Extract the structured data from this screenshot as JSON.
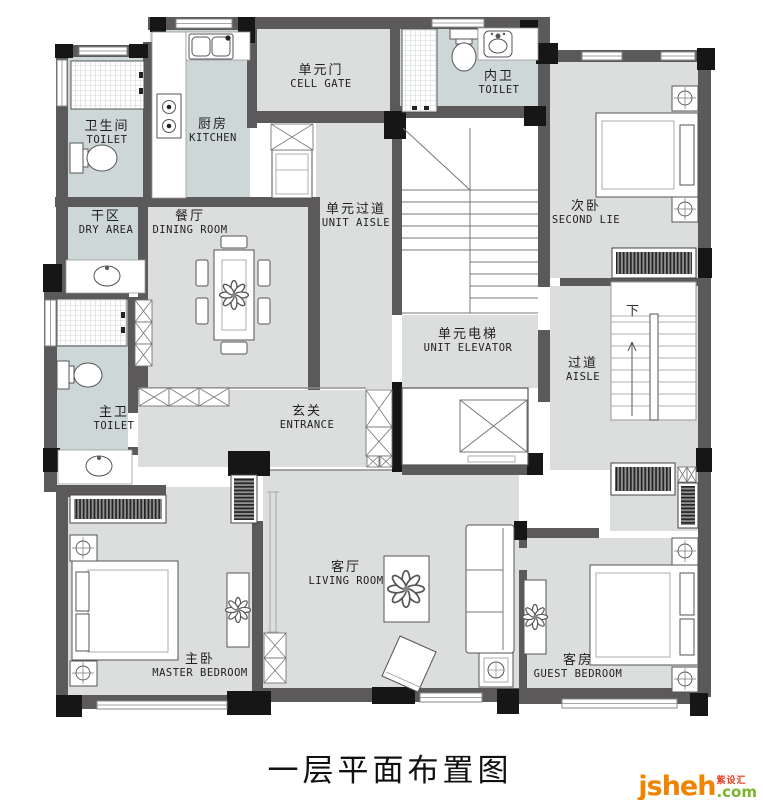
{
  "title": "一层平面布置图",
  "stairs": {
    "down": "下"
  },
  "rooms": {
    "toilet1": {
      "zh": "卫生间",
      "en": "TOILET"
    },
    "kitchen": {
      "zh": "厨房",
      "en": "KITCHEN"
    },
    "dry_area": {
      "zh": "干区",
      "en": "DRY AREA"
    },
    "dining": {
      "zh": "餐厅",
      "en": "DINING ROOM"
    },
    "cell_gate": {
      "zh": "单元门",
      "en": "CELL GATE"
    },
    "inner_toilet": {
      "zh": "内卫",
      "en": "TOILET"
    },
    "unit_aisle": {
      "zh": "单元过道",
      "en": "UNIT AISLE"
    },
    "second_bedroom": {
      "zh": "次卧",
      "en": "SECOND LIE"
    },
    "unit_elevator": {
      "zh": "单元电梯",
      "en": "UNIT ELEVATOR"
    },
    "aisle": {
      "zh": "过道",
      "en": "AISLE"
    },
    "master_toilet": {
      "zh": "主卫",
      "en": "TOILET"
    },
    "entrance": {
      "zh": "玄关",
      "en": "ENTRANCE"
    },
    "master_bedroom": {
      "zh": "主卧",
      "en": "MASTER BEDROOM"
    },
    "living_room": {
      "zh": "客厅",
      "en": "LIVING ROOM"
    },
    "guest_bedroom": {
      "zh": "客房",
      "en": "GUEST BEDROOM"
    }
  },
  "watermark": {
    "name": "jsheh",
    "tld": ".com",
    "badge": "紫设汇"
  },
  "colors": {
    "wall": "#5b5959",
    "black": "#161616",
    "floor": "#dcdddd",
    "wet": "#cdd7d7",
    "line": "#666666",
    "wm-orange": "#f08300",
    "wm-green": "#7ab52c",
    "wm-red": "#e8391d"
  }
}
